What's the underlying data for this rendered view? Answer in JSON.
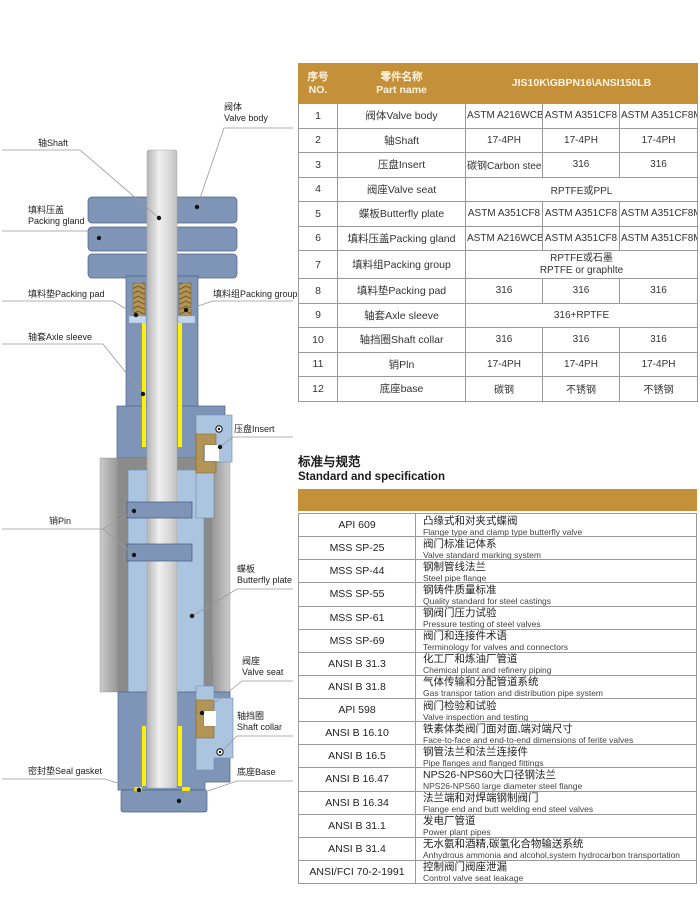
{
  "diagram": {
    "labels": {
      "valve_body_zh": "阀体",
      "valve_body_en": "Valve body",
      "shaft": "轴Shaft",
      "packing_gland_zh": "填料压盖",
      "packing_gland_en": "Packing gland",
      "packing_pad": "填料垫Packing pad",
      "packing_group": "填料组Packing group",
      "axle_sleeve": "轴套Axle sleeve",
      "insert": "压盘Insert",
      "pin": "销Pin",
      "butterfly_zh": "蝶板",
      "butterfly_en": "Butterfly plate",
      "valve_seat_zh": "阀座",
      "valve_seat_en": "Valve seat",
      "shaft_collar_zh": "轴挡圈",
      "shaft_collar_en": "Shaft collar",
      "seal_gasket": "密封垫Seal gasket",
      "base": "底座Base"
    }
  },
  "parts_table": {
    "header": {
      "no_zh": "序号",
      "no_en": "NO.",
      "name_zh": "零件名称",
      "name_en": "Part name",
      "spec": "JIS10K\\GBPN16\\ANSI150LB"
    },
    "rows": [
      {
        "no": "1",
        "name": "阀体Valve body",
        "cells": [
          "ASTM A216WCB",
          "ASTM A351CF8",
          "ASTM A351CF8M"
        ]
      },
      {
        "no": "2",
        "name": "轴Shaft",
        "cells": [
          "17-4PH",
          "17-4PH",
          "17-4PH"
        ]
      },
      {
        "no": "3",
        "name": "压盘Insert",
        "cells": [
          "碳钢Carbon steel",
          "316",
          "316"
        ]
      },
      {
        "no": "4",
        "name": "阀座Valve seat",
        "merged": [
          "RPTFE或PPL"
        ]
      },
      {
        "no": "5",
        "name": "蝶板Butterfly plate",
        "cells": [
          "ASTM A351CF8",
          "ASTM A351CF8",
          "ASTM A351CF8M"
        ]
      },
      {
        "no": "6",
        "name": "填料压盖Packing gland",
        "cells": [
          "ASTM A216WCB",
          "ASTM A351CF8",
          "ASTM A351CF8M"
        ]
      },
      {
        "no": "7",
        "name": "填料组Packing group",
        "merged": [
          "RPTFE或石墨",
          "RPTFE or graphlte"
        ],
        "tall": true
      },
      {
        "no": "8",
        "name": "填料垫Packing pad",
        "cells": [
          "316",
          "316",
          "316"
        ]
      },
      {
        "no": "9",
        "name": "轴套Axle sleeve",
        "merged": [
          "316+RPTFE"
        ]
      },
      {
        "no": "10",
        "name": "轴挡圈Shaft collar",
        "cells": [
          "316",
          "316",
          "316"
        ]
      },
      {
        "no": "11",
        "name": "销Pln",
        "cells": [
          "17-4PH",
          "17-4PH",
          "17-4PH"
        ]
      },
      {
        "no": "12",
        "name": "底座base",
        "cells": [
          "碳钢",
          "不锈钢",
          "不锈钢"
        ]
      }
    ]
  },
  "standards": {
    "title_zh": "标准与规范",
    "title_en": "Standard and specification",
    "rows": [
      {
        "code": "API 609",
        "zh": "凸缘式和对夹式蝶阀",
        "en": "Flange type and clamp type butterfly valve"
      },
      {
        "code": "MSS SP-25",
        "zh": "阀门标准记体系",
        "en": "Valve standard marking system"
      },
      {
        "code": "MSS SP-44",
        "zh": "钢制管线法兰",
        "en": "Steel pipe flange"
      },
      {
        "code": "MSS SP-55",
        "zh": "钢铸件质量标准",
        "en": "Quality standard for steel castings"
      },
      {
        "code": "MSS SP-61",
        "zh": "钢阀门压力试验",
        "en": "Pressure testing of steel valves"
      },
      {
        "code": "MSS SP-69",
        "zh": "阀门和连接件术语",
        "en": "Terminology for valves and connectors"
      },
      {
        "code": "ANSI B 31.3",
        "zh": "化工厂和炼油厂管道",
        "en": "Chemical plant and refinery piping"
      },
      {
        "code": "ANSI B 31.8",
        "zh": "气体传输和分配管道系统",
        "en": "Gas transpor tation and distribution pipe system"
      },
      {
        "code": "API 598",
        "zh": "阀门检验和试验",
        "en": "Valve inspection and testing"
      },
      {
        "code": "ANSI B 16.10",
        "zh": "铁素体类阀门面对面,端对端尺寸",
        "en": "Face-to-face and end-to-end dimensions of ferite valves"
      },
      {
        "code": "ANSI B 16.5",
        "zh": "钢管法兰和法兰连接件",
        "en": "Pipe flanges and flanged fittings"
      },
      {
        "code": "ANSI B 16.47",
        "zh": "NPS26-NPS60大口径钢法兰",
        "en": "NPS26-NPS60 large diameter steel flange"
      },
      {
        "code": "ANSI B 16.34",
        "zh": "法兰端和对焊端钢制阀门",
        "en": "Flange end and butt welding end steel valves"
      },
      {
        "code": "ANSI B 31.1",
        "zh": "发电厂管道",
        "en": "Power plant pipes"
      },
      {
        "code": "ANSI B 31.4",
        "zh": "无水氨和酒精,碳氢化合物输送系统",
        "en": "Anhydrous ammonia and alcohol,system hydrocarbon transportation"
      },
      {
        "code": "ANSI/FCI 70-2-1991",
        "zh": "控制阀门阀座泄漏",
        "en": "Control valve seat leakage"
      }
    ]
  },
  "colors": {
    "accent_gold": "#C4913A",
    "body_blue": "#7E95B7",
    "butterfly_blue": "#ABC4E0",
    "sleeve_yellow": "#FFF100",
    "packing_bronze": "#B29556",
    "grid_line": "#999999"
  }
}
